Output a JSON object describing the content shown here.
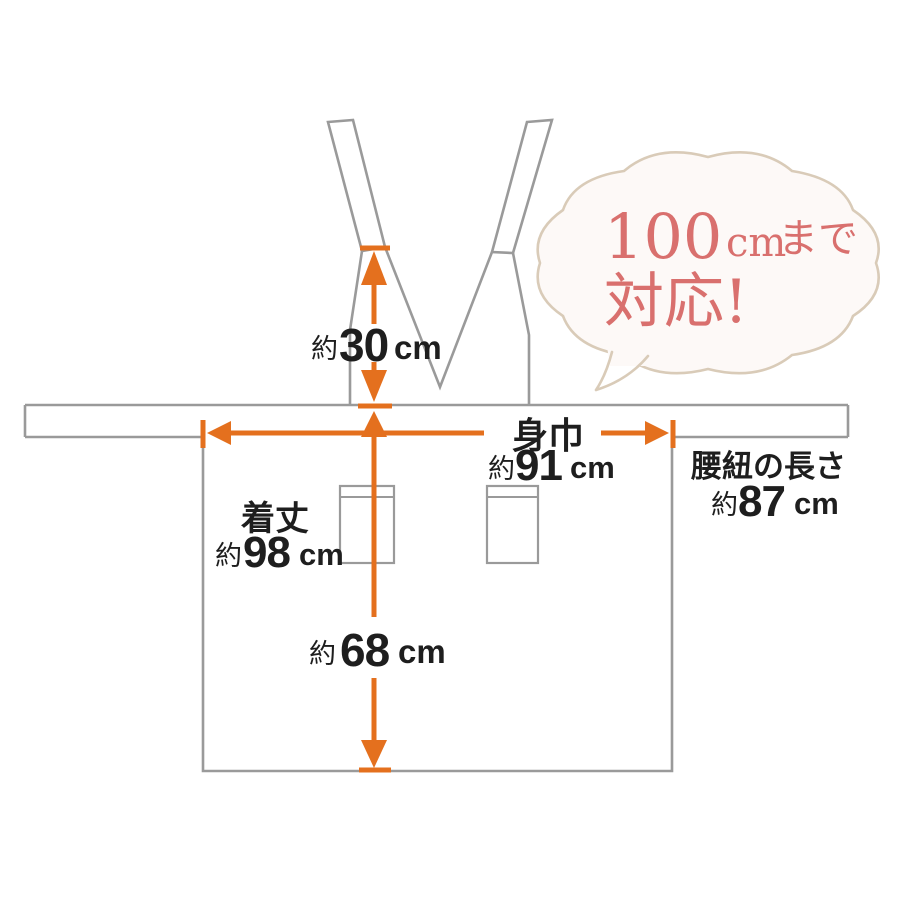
{
  "colors": {
    "accent": "#e4701e",
    "outline": "#9a9a9a",
    "ink": "#1e1e1e",
    "bubble_stroke": "#d9cbb8",
    "bubble_fill": "#fdf9f7",
    "bubble_ink": "#d9706e",
    "background": "#ffffff"
  },
  "bubble": {
    "number": "100",
    "unit": "cm",
    "suffix": "まで",
    "line2": "対応!"
  },
  "measurements": {
    "neck_drop": {
      "approx": "約",
      "value": "30",
      "unit": "cm"
    },
    "body_width": {
      "label": "身巾",
      "approx": "約",
      "value": "91",
      "unit": "cm"
    },
    "length": {
      "label": "着丈",
      "approx": "約",
      "value": "98",
      "unit": "cm"
    },
    "skirt_drop": {
      "approx": "約",
      "value": "68",
      "unit": "cm"
    },
    "waist_tie": {
      "label": "腰紐の長さ",
      "approx": "約",
      "value": "87",
      "unit": "cm"
    }
  }
}
